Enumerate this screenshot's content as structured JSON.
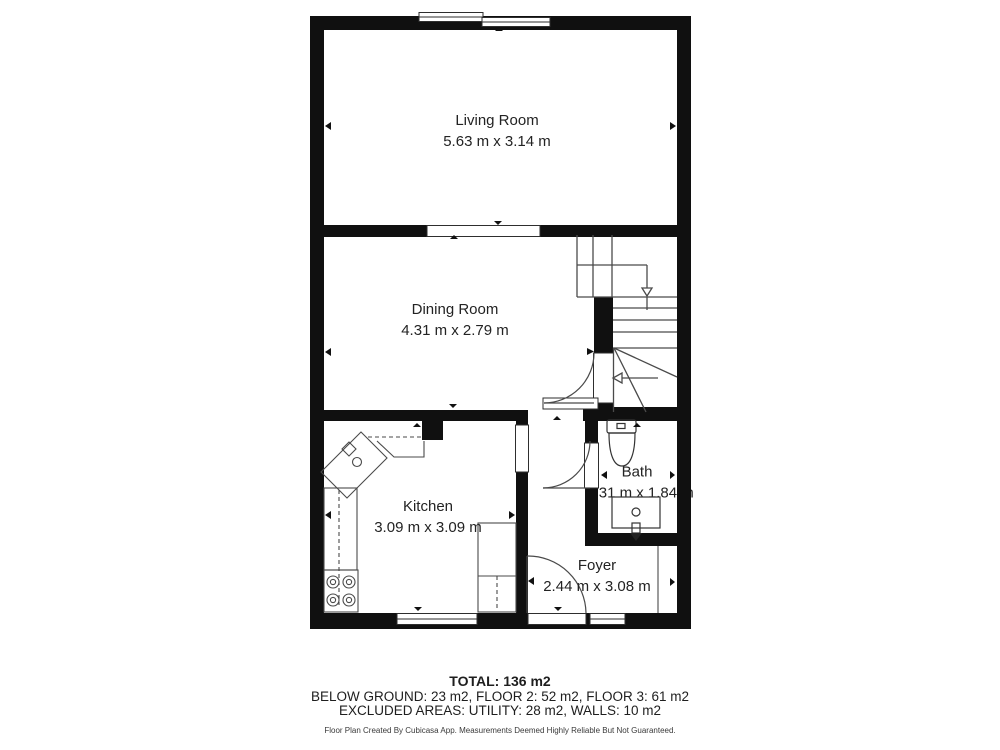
{
  "rooms": [
    {
      "id": "living-room",
      "name": "Living Room",
      "dims": "5.63 m x 3.14 m"
    },
    {
      "id": "dining-room",
      "name": "Dining Room",
      "dims": "4.31 m x 2.79 m"
    },
    {
      "id": "kitchen",
      "name": "Kitchen",
      "dims": "3.09 m x 3.09 m"
    },
    {
      "id": "bath",
      "name": "Bath",
      "dims": "1.31 m x 1.84 m"
    },
    {
      "id": "foyer",
      "name": "Foyer",
      "dims": "2.44 m x 3.08 m"
    }
  ],
  "summary": {
    "total": "TOTAL: 136 m2",
    "floors": "BELOW GROUND: 23 m2, FLOOR 2: 52 m2, FLOOR 3: 61 m2",
    "excluded": "EXCLUDED AREAS: UTILITY: 28 m2, WALLS: 10 m2"
  },
  "footer": {
    "disclaimer": "Floor Plan Created By Cubicasa App. Measurements Deemed Highly Reliable But Not Guaranteed."
  },
  "colors": {
    "wall": "#101010",
    "line": "#4a4a4a",
    "text": "#232323"
  }
}
